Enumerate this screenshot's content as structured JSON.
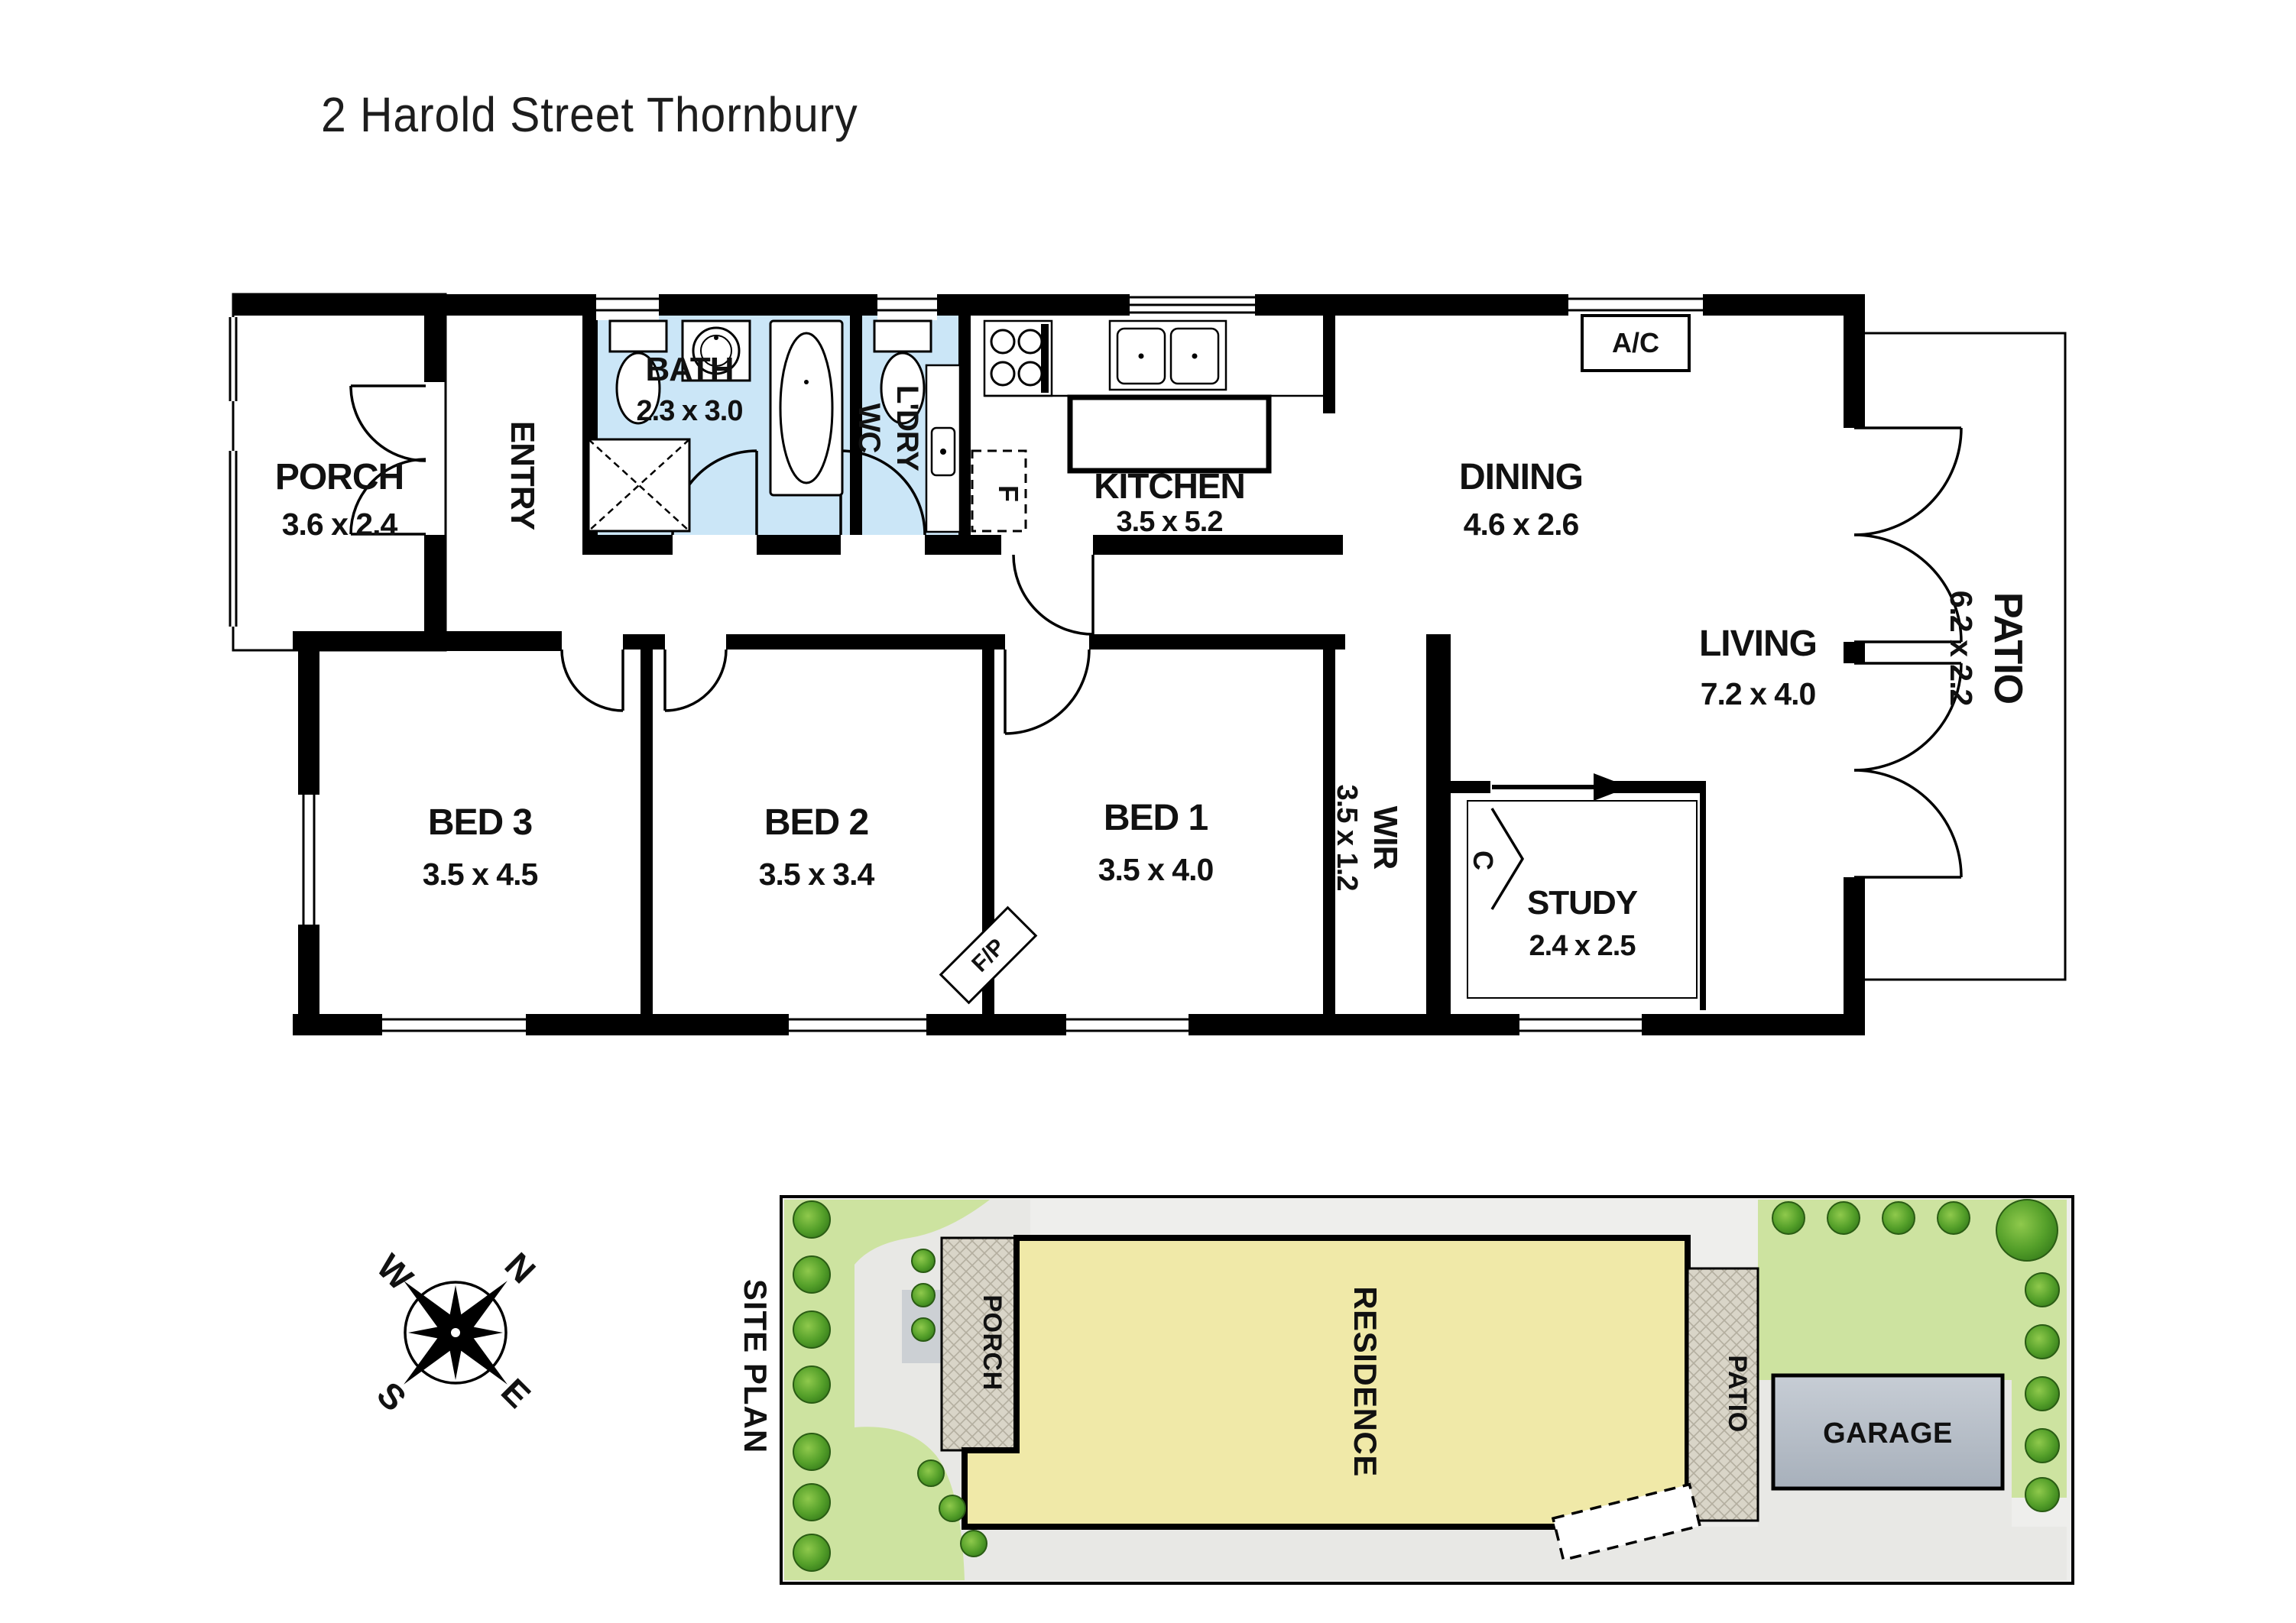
{
  "title": "2 Harold Street Thornbury",
  "floor_plan": {
    "rooms": {
      "porch": {
        "name": "PORCH",
        "dims": "3.6 x 2.4"
      },
      "entry": {
        "name": "ENTRY"
      },
      "bath": {
        "name": "BATH",
        "dims": "2.3 x 3.0"
      },
      "laundry": {
        "line1": "L'DRY",
        "line2": "WC"
      },
      "kitchen": {
        "name": "KITCHEN",
        "dims": "3.5 x 5.2"
      },
      "dining": {
        "name": "DINING",
        "dims": "4.6 x 2.6"
      },
      "living": {
        "name": "LIVING",
        "dims": "7.2 x 4.0"
      },
      "patio": {
        "name": "PATIO",
        "dims": "6.2 x 2.2"
      },
      "bed1": {
        "name": "BED 1",
        "dims": "3.5 x 4.0"
      },
      "bed2": {
        "name": "BED 2",
        "dims": "3.5 x 3.4"
      },
      "bed3": {
        "name": "BED 3",
        "dims": "3.5 x 4.5"
      },
      "wir": {
        "name": "WIR",
        "dims": "3.5 x 1.2"
      },
      "study": {
        "name": "STUDY",
        "dims": "2.4 x 2.5"
      }
    },
    "markers": {
      "ac": "A/C",
      "fireplace": "F/P",
      "fridge": "F",
      "cupboard": "C"
    }
  },
  "site_plan": {
    "label": "SITE PLAN",
    "areas": {
      "porch": "PORCH",
      "residence": "RESIDENCE",
      "patio": "PATIO",
      "garage": "GARAGE"
    }
  },
  "compass": {
    "north": "N",
    "east": "E",
    "south": "S",
    "west": "W"
  },
  "colors": {
    "wet_area": "#cbe6f7",
    "lawn": "#cde3a0",
    "residence": "#f0e9a8",
    "paving": "#d9d5c8",
    "garage": "#b6bec7",
    "site_bg": "#eeeeec",
    "wall": "#000000"
  }
}
